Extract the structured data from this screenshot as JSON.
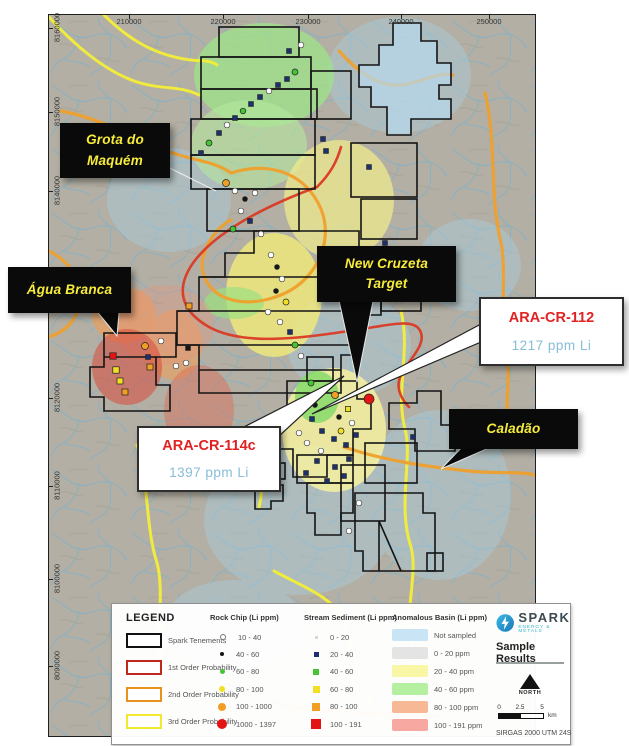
{
  "map": {
    "top_axis_labels": [
      {
        "label": "210000",
        "x": 80
      },
      {
        "label": "220000",
        "x": 174
      },
      {
        "label": "230000",
        "x": 259
      },
      {
        "label": "240000",
        "x": 352
      },
      {
        "label": "250000",
        "x": 440
      }
    ],
    "left_axis_labels": [
      {
        "label": "8160000",
        "y": 13
      },
      {
        "label": "8150000",
        "y": 97
      },
      {
        "label": "8140000",
        "y": 176
      },
      {
        "label": "8120000",
        "y": 383
      },
      {
        "label": "8110000",
        "y": 471
      },
      {
        "label": "8100000",
        "y": 564
      },
      {
        "label": "8090000",
        "y": 651
      }
    ],
    "callouts": {
      "grota": {
        "line1": "Grota do",
        "line2": "Maquém"
      },
      "agua": {
        "label": "Água Branca"
      },
      "cruzeta": {
        "line1": "New Cruzeta",
        "line2": "Target"
      },
      "caladao": {
        "label": "Caladão"
      }
    },
    "sample_callouts": {
      "ara112": {
        "title": "ARA-CR-112",
        "value": "1217 ppm Li"
      },
      "ara114c": {
        "title": "ARA-CR-114c",
        "value": "1397 ppm Li"
      }
    },
    "sample_points": [
      {
        "x": 170,
        "y": 118,
        "t": "s",
        "c": "n",
        "r": 2.4
      },
      {
        "x": 178,
        "y": 110,
        "t": "c",
        "c": "w",
        "r": 2.8
      },
      {
        "x": 186,
        "y": 103,
        "t": "s",
        "c": "n",
        "r": 2.4
      },
      {
        "x": 194,
        "y": 96,
        "t": "c",
        "c": "g",
        "r": 2.8
      },
      {
        "x": 202,
        "y": 89,
        "t": "s",
        "c": "n",
        "r": 2.4
      },
      {
        "x": 211,
        "y": 82,
        "t": "s",
        "c": "n",
        "r": 2.4
      },
      {
        "x": 220,
        "y": 76,
        "t": "c",
        "c": "w",
        "r": 2.8
      },
      {
        "x": 229,
        "y": 70,
        "t": "s",
        "c": "n",
        "r": 2.4
      },
      {
        "x": 238,
        "y": 64,
        "t": "s",
        "c": "n",
        "r": 2.4
      },
      {
        "x": 246,
        "y": 57,
        "t": "c",
        "c": "g",
        "r": 3
      },
      {
        "x": 160,
        "y": 128,
        "t": "c",
        "c": "g",
        "r": 3
      },
      {
        "x": 152,
        "y": 138,
        "t": "s",
        "c": "n",
        "r": 2.4
      },
      {
        "x": 240,
        "y": 36,
        "t": "s",
        "c": "n",
        "r": 2.4
      },
      {
        "x": 252,
        "y": 30,
        "t": "c",
        "c": "w",
        "r": 2.8
      },
      {
        "x": 177,
        "y": 168,
        "t": "c",
        "c": "o",
        "r": 3.5
      },
      {
        "x": 186,
        "y": 176,
        "t": "c",
        "c": "w",
        "r": 2.8
      },
      {
        "x": 196,
        "y": 184,
        "t": "c",
        "c": "k",
        "r": 2.4
      },
      {
        "x": 206,
        "y": 178,
        "t": "c",
        "c": "w",
        "r": 2.8
      },
      {
        "x": 192,
        "y": 196,
        "t": "c",
        "c": "w",
        "r": 2.8
      },
      {
        "x": 201,
        "y": 206,
        "t": "s",
        "c": "n",
        "r": 2.4
      },
      {
        "x": 184,
        "y": 214,
        "t": "c",
        "c": "g",
        "r": 3
      },
      {
        "x": 212,
        "y": 219,
        "t": "c",
        "c": "w",
        "r": 2.8
      },
      {
        "x": 222,
        "y": 240,
        "t": "c",
        "c": "w",
        "r": 2.8
      },
      {
        "x": 228,
        "y": 252,
        "t": "c",
        "c": "k",
        "r": 2.4
      },
      {
        "x": 233,
        "y": 264,
        "t": "c",
        "c": "w",
        "r": 2.8
      },
      {
        "x": 227,
        "y": 276,
        "t": "c",
        "c": "k",
        "r": 2.4
      },
      {
        "x": 237,
        "y": 287,
        "t": "c",
        "c": "y",
        "r": 3
      },
      {
        "x": 219,
        "y": 297,
        "t": "c",
        "c": "w",
        "r": 2.8
      },
      {
        "x": 231,
        "y": 307,
        "t": "c",
        "c": "w",
        "r": 2.8
      },
      {
        "x": 241,
        "y": 317,
        "t": "s",
        "c": "n",
        "r": 2.4
      },
      {
        "x": 140,
        "y": 291,
        "t": "s",
        "c": "o",
        "r": 3
      },
      {
        "x": 246,
        "y": 330,
        "t": "c",
        "c": "g",
        "r": 3
      },
      {
        "x": 252,
        "y": 341,
        "t": "c",
        "c": "w",
        "r": 2.8
      },
      {
        "x": 274,
        "y": 124,
        "t": "s",
        "c": "n",
        "r": 2.4
      },
      {
        "x": 277,
        "y": 136,
        "t": "s",
        "c": "n",
        "r": 2.4
      },
      {
        "x": 320,
        "y": 152,
        "t": "s",
        "c": "n",
        "r": 2.4
      },
      {
        "x": 336,
        "y": 228,
        "t": "s",
        "c": "n",
        "r": 2.4
      },
      {
        "x": 64,
        "y": 341,
        "t": "s",
        "c": "r",
        "r": 3.2
      },
      {
        "x": 67,
        "y": 355,
        "t": "s",
        "c": "y",
        "r": 3.2
      },
      {
        "x": 71,
        "y": 366,
        "t": "s",
        "c": "y",
        "r": 3
      },
      {
        "x": 76,
        "y": 377,
        "t": "s",
        "c": "o",
        "r": 3
      },
      {
        "x": 96,
        "y": 331,
        "t": "c",
        "c": "o",
        "r": 3.5
      },
      {
        "x": 99,
        "y": 342,
        "t": "s",
        "c": "n",
        "r": 2.4
      },
      {
        "x": 101,
        "y": 352,
        "t": "s",
        "c": "o",
        "r": 3
      },
      {
        "x": 127,
        "y": 351,
        "t": "c",
        "c": "w",
        "r": 2.8
      },
      {
        "x": 137,
        "y": 348,
        "t": "c",
        "c": "w",
        "r": 2.8
      },
      {
        "x": 139,
        "y": 333,
        "t": "s",
        "c": "k",
        "r": 2.4
      },
      {
        "x": 112,
        "y": 326,
        "t": "c",
        "c": "w",
        "r": 2.8
      },
      {
        "x": 320,
        "y": 384,
        "t": "c",
        "c": "r",
        "r": 5
      },
      {
        "x": 286,
        "y": 380,
        "t": "c",
        "c": "o",
        "r": 3.5
      },
      {
        "x": 262,
        "y": 368,
        "t": "c",
        "c": "g",
        "r": 3
      },
      {
        "x": 252,
        "y": 392,
        "t": "s",
        "c": "n",
        "r": 2.4
      },
      {
        "x": 263,
        "y": 404,
        "t": "s",
        "c": "n",
        "r": 2.4
      },
      {
        "x": 273,
        "y": 416,
        "t": "s",
        "c": "n",
        "r": 2.4
      },
      {
        "x": 285,
        "y": 424,
        "t": "s",
        "c": "n",
        "r": 2.4
      },
      {
        "x": 297,
        "y": 430,
        "t": "s",
        "c": "n",
        "r": 2.4
      },
      {
        "x": 307,
        "y": 420,
        "t": "s",
        "c": "n",
        "r": 2.4
      },
      {
        "x": 300,
        "y": 444,
        "t": "s",
        "c": "n",
        "r": 2.4
      },
      {
        "x": 286,
        "y": 452,
        "t": "s",
        "c": "n",
        "r": 2.4
      },
      {
        "x": 268,
        "y": 446,
        "t": "s",
        "c": "n",
        "r": 2.4
      },
      {
        "x": 257,
        "y": 458,
        "t": "s",
        "c": "n",
        "r": 2.4
      },
      {
        "x": 278,
        "y": 466,
        "t": "s",
        "c": "n",
        "r": 2.4
      },
      {
        "x": 295,
        "y": 461,
        "t": "s",
        "c": "n",
        "r": 2.4
      },
      {
        "x": 246,
        "y": 402,
        "t": "c",
        "c": "w",
        "r": 2.8
      },
      {
        "x": 258,
        "y": 428,
        "t": "c",
        "c": "w",
        "r": 2.8
      },
      {
        "x": 272,
        "y": 436,
        "t": "c",
        "c": "w",
        "r": 2.8
      },
      {
        "x": 303,
        "y": 408,
        "t": "c",
        "c": "w",
        "r": 2.8
      },
      {
        "x": 250,
        "y": 418,
        "t": "c",
        "c": "w",
        "r": 2.8
      },
      {
        "x": 292,
        "y": 416,
        "t": "c",
        "c": "y",
        "r": 3
      },
      {
        "x": 299,
        "y": 394,
        "t": "s",
        "c": "y",
        "r": 2.6
      },
      {
        "x": 266,
        "y": 390,
        "t": "c",
        "c": "k",
        "r": 2.4
      },
      {
        "x": 290,
        "y": 402,
        "t": "c",
        "c": "k",
        "r": 2.4
      },
      {
        "x": 364,
        "y": 422,
        "t": "s",
        "c": "n",
        "r": 2.4
      },
      {
        "x": 310,
        "y": 488,
        "t": "c",
        "c": "w",
        "r": 2.8
      },
      {
        "x": 300,
        "y": 516,
        "t": "c",
        "c": "w",
        "r": 2.8
      }
    ]
  },
  "legend": {
    "title": "LEGEND",
    "tenement_items": [
      {
        "label": "Spark Tenements",
        "color": "#111111"
      },
      {
        "label": "1st Order Probability",
        "color": "#c0281e"
      },
      {
        "label": "2nd Order Probability",
        "color": "#e8921e"
      },
      {
        "label": "3rd Order Probability",
        "color": "#f2e82e"
      }
    ],
    "rock_chip": {
      "header": "Rock Chip (Li ppm)",
      "items": [
        {
          "label": "10 - 40",
          "color": "#ffffff",
          "size": 4,
          "open": true
        },
        {
          "label": "40 - 60",
          "color": "#161616",
          "size": 4,
          "open": false
        },
        {
          "label": "60 - 80",
          "color": "#45c436",
          "size": 5,
          "open": false
        },
        {
          "label": "80 - 100",
          "color": "#f0df22",
          "size": 6,
          "open": false
        },
        {
          "label": "100 - 1000",
          "color": "#f09e24",
          "size": 8,
          "open": false
        },
        {
          "label": "1000 - 1397",
          "color": "#e31414",
          "size": 10,
          "open": false
        }
      ]
    },
    "stream_sediment": {
      "header": "Stream Sediment (Li ppm)",
      "items": [
        {
          "label": "0 - 20",
          "color": "#d8d8d8",
          "size": 3
        },
        {
          "label": "20 - 40",
          "color": "#1c2f6e",
          "size": 5
        },
        {
          "label": "40 - 60",
          "color": "#45c436",
          "size": 6
        },
        {
          "label": "60 - 80",
          "color": "#f0df22",
          "size": 7
        },
        {
          "label": "80 - 100",
          "color": "#f09e24",
          "size": 8
        },
        {
          "label": "100 - 191",
          "color": "#e31414",
          "size": 10
        }
      ]
    },
    "anomalous_basin": {
      "header": "Anomalous Basin (Li ppm)",
      "items": [
        {
          "label": "Not sampled",
          "color": "#c9e4f5"
        },
        {
          "label": "0 - 20 ppm",
          "color": "#e4e4e4"
        },
        {
          "label": "20 - 40 ppm",
          "color": "#f9f6a6"
        },
        {
          "label": "40 - 60 ppm",
          "color": "#b4f0a0"
        },
        {
          "label": "80 - 100 ppm",
          "color": "#f7b896"
        },
        {
          "label": "100 - 191 ppm",
          "color": "#f7a8a0"
        }
      ]
    },
    "branding": {
      "logo_text": "SPARK",
      "logo_subtext": "ENERGY & METALS",
      "section_title": "Sample Results"
    },
    "north_label": "NORTH",
    "scale": {
      "ticks": [
        "0",
        "2.5",
        "5"
      ],
      "unit": "km"
    },
    "datum": "SIRGAS 2000  UTM 24S"
  },
  "colors": {
    "sample": {
      "n": "#1c2f6e",
      "w": "#ffffff",
      "g": "#45c436",
      "y": "#f0df22",
      "o": "#f09e24",
      "r": "#e31414",
      "k": "#161616"
    }
  }
}
